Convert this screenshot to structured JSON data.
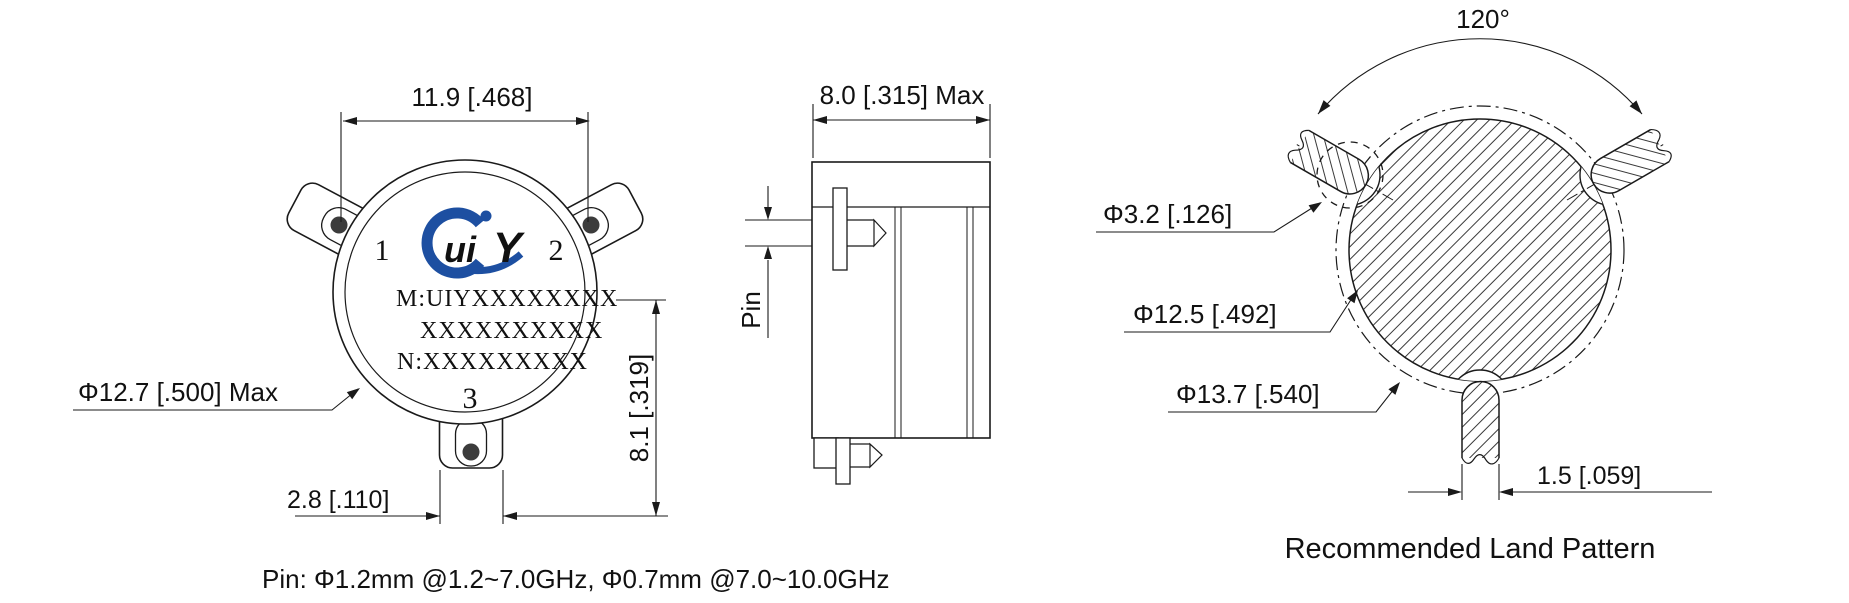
{
  "drawing": {
    "top_view": {
      "dim_width": "11.9 [.468]",
      "dim_diameter": "Φ12.7 [.500] Max",
      "dim_tab_width": "2.8 [.110]",
      "dim_height": "8.1 [.319]",
      "port1": "1",
      "port2": "2",
      "port3": "3",
      "label_line1": "M:UIYXXXXXXXX",
      "label_line2": "XXXXXXXXXX",
      "label_line3": "N:XXXXXXXXX",
      "logo_text_1": "ui",
      "logo_text_2": "Y"
    },
    "side_view": {
      "dim_width": "8.0 [.315] Max",
      "pin_label": "Pin"
    },
    "land_pattern": {
      "title": "Recommended Land Pattern",
      "dim_angle": "120°",
      "dim_pad_hole": "Φ3.2 [.126]",
      "dim_inner_circle": "Φ12.5 [.492]",
      "dim_outer_circle": "Φ13.7 [.540]",
      "dim_pad_width": "1.5 [.059]"
    },
    "footnote": "Pin: Φ1.2mm @1.2~7.0GHz, Φ0.7mm @7.0~10.0GHz",
    "colors": {
      "line": "#1a1a1a",
      "logo_red": "#e81c24",
      "logo_blue": "#1d4fa1",
      "hole": "#3c3c3c"
    }
  }
}
